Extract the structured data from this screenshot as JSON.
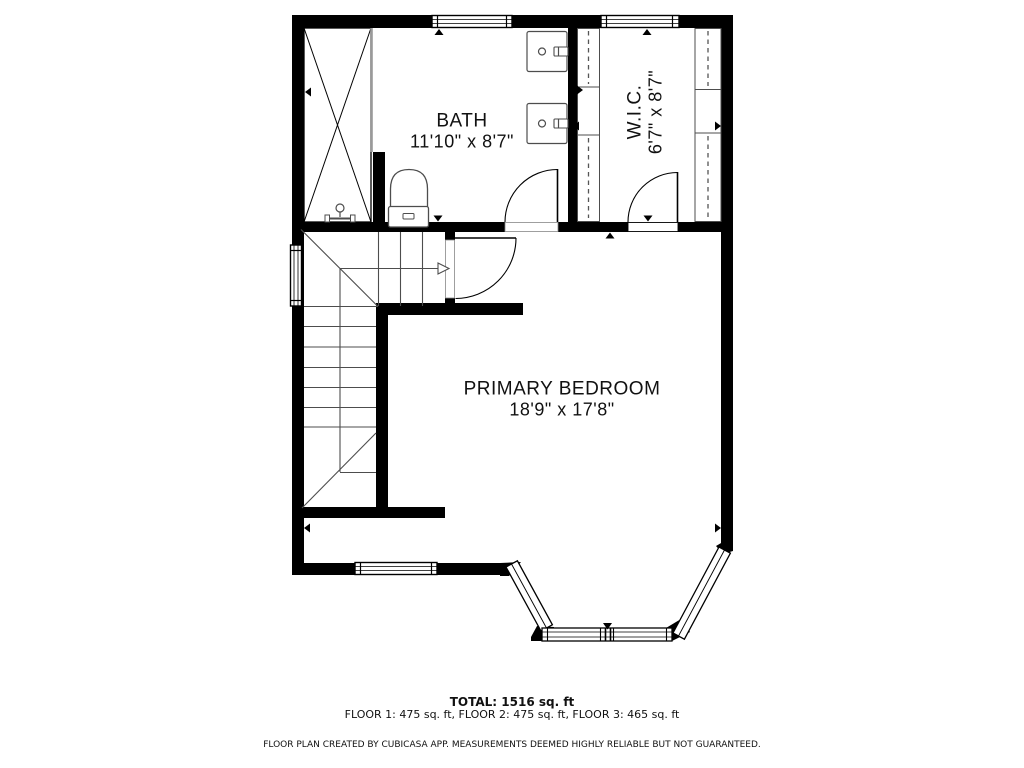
{
  "plan": {
    "rooms": {
      "bath": {
        "name": "BATH",
        "dims": "11'10\" x 8'7\""
      },
      "wic": {
        "name": "W.I.C.",
        "dims": "6'7\" x 8'7\""
      },
      "primary_bedroom": {
        "name": "PRIMARY BEDROOM",
        "dims": "18'9\" x 17'8\""
      }
    }
  },
  "footer": {
    "total": "TOTAL: 1516 sq. ft",
    "floor_breakdown": "FLOOR 1: 475 sq. ft, FLOOR 2: 475 sq. ft, FLOOR 3: 465 sq. ft",
    "disclaimer": "FLOOR PLAN CREATED BY CUBICASA APP. MEASUREMENTS DEEMED HIGHLY RELIABLE BUT NOT GUARANTEED."
  },
  "colors": {
    "wall": "#000000",
    "background": "#ffffff",
    "fixture_line": "#4d4d4d",
    "glass": "#9a9a9a"
  }
}
